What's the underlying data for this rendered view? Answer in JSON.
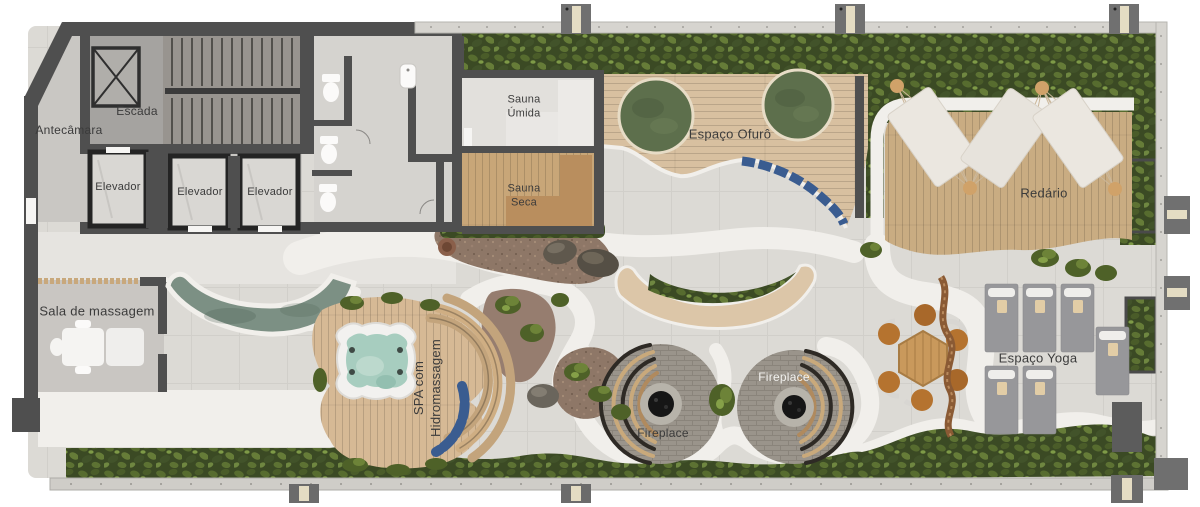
{
  "meta": {
    "type": "amenities-floor-plan",
    "view": "top-down 3d render",
    "language": "pt-BR"
  },
  "labels": {
    "antecamara": "Antecâmara",
    "escada": "Escada",
    "elevador_1": "Elevador",
    "elevador_2": "Elevador",
    "elevador_3": "Elevador",
    "sauna_umida": "Sauna\nÚmida",
    "sauna_seca": "Sauna\nSeca",
    "espaco_ofuro": "Espaço Ofurô",
    "redario": "Redário",
    "sala_de_massagem": "Sala de massagem",
    "spa_hidromassagem": "SPA com\nHidromassagem",
    "fireplace_lower": "Fireplace",
    "fireplace_upper": "Fireplace",
    "espaco_yoga": "Espaço Yoga"
  },
  "colors": {
    "wall": "#4f4f4f",
    "terrace_floor": "#dcdad5",
    "path_white": "#f1efeb",
    "hedge_green": "#3b4a24",
    "deck_wood": "#d8c0a0",
    "redario_wood": "#c9ac82",
    "ofuro_water": "#5d6f4c",
    "spa_tub_water": "#a7cdbf",
    "massage_pool_water": "#7c9084",
    "cushion_blue": "#3a5c90",
    "gravel_brown": "#8e7767",
    "fireplace_paving": "#9a948b",
    "fire_coals": "#161616",
    "yoga_mat_gray": "#97979a",
    "label_text": "#3b3b3b"
  }
}
